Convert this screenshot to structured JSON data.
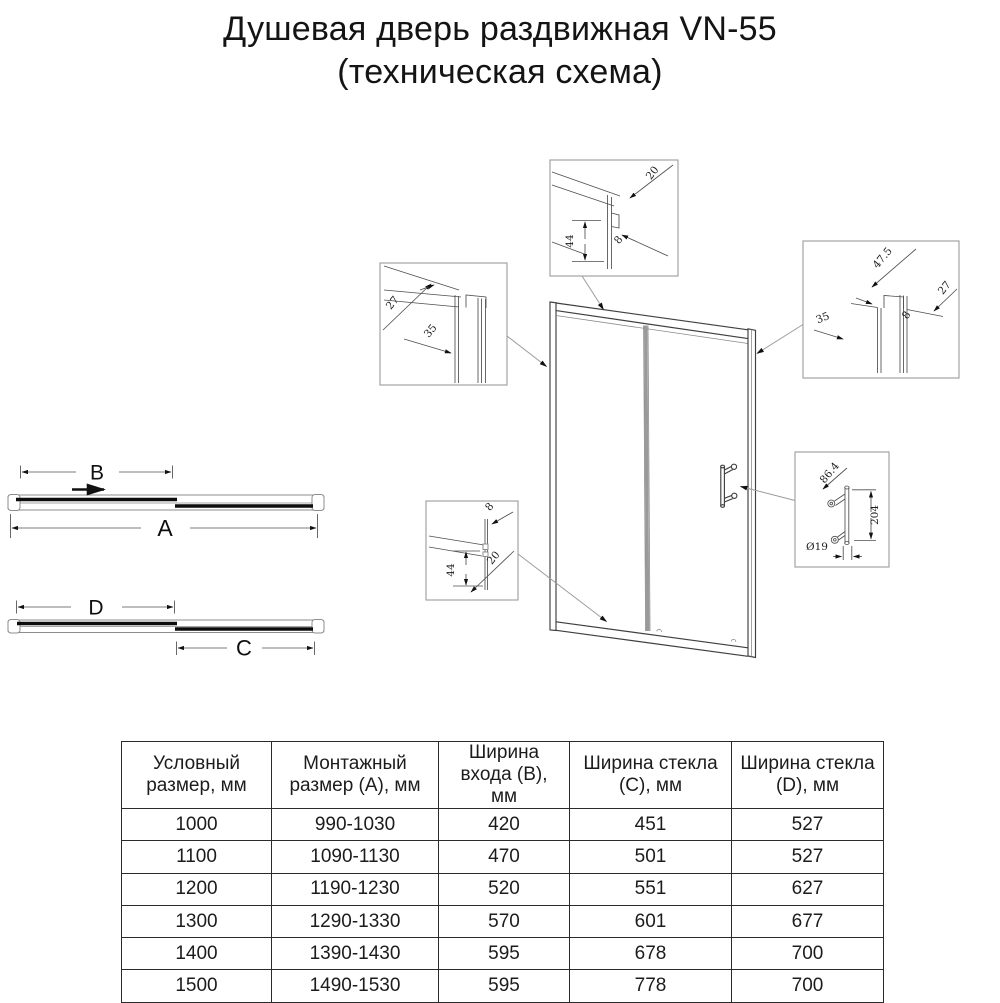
{
  "title": {
    "line1": "Душевая дверь раздвижная VN-55",
    "line2": "(техническая схема)"
  },
  "plan": {
    "a": "A",
    "b": "B",
    "c": "C",
    "d": "D"
  },
  "callouts": {
    "top": {
      "d20": "20",
      "d44": "44",
      "d8": "8"
    },
    "left": {
      "d27": "27",
      "d35": "35"
    },
    "right": {
      "d475": "47.5",
      "d27": "27",
      "d35": "35",
      "d8": "8"
    },
    "bottom": {
      "d8": "8",
      "d44": "44",
      "d20": "20"
    },
    "handle": {
      "d864": "86.4",
      "d204": "204",
      "d19": "Ø19"
    }
  },
  "table": {
    "headers": [
      "Условный размер, мм",
      "Монтажный размер (А), мм",
      "Ширина входа (В), мм",
      "Ширина стекла (С), мм",
      "Ширина стекла (D), мм"
    ],
    "rows": [
      [
        "1000",
        "990-1030",
        "420",
        "451",
        "527"
      ],
      [
        "1100",
        "1090-1130",
        "470",
        "501",
        "527"
      ],
      [
        "1200",
        "1190-1230",
        "520",
        "551",
        "627"
      ],
      [
        "1300",
        "1290-1330",
        "570",
        "601",
        "677"
      ],
      [
        "1400",
        "1390-1430",
        "595",
        "678",
        "700"
      ],
      [
        "1500",
        "1490-1530",
        "595",
        "778",
        "700"
      ]
    ]
  },
  "colors": {
    "ink": "#1a1a1a",
    "line_gray": "#8d8d8d"
  }
}
